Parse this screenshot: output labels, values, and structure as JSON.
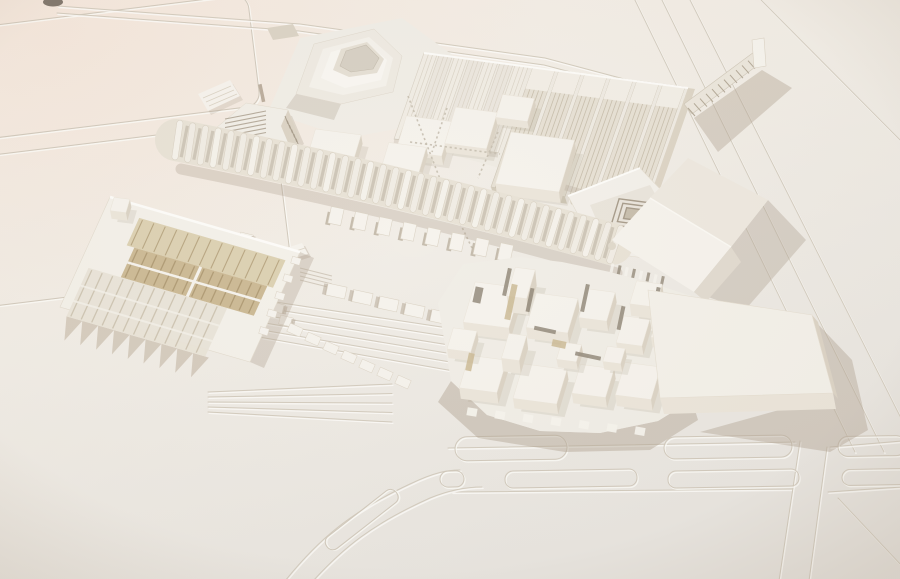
{
  "scene": {
    "type": "photograph",
    "subject": "architectural scale model",
    "description": "Overhead oblique photograph of an all-white architectural site model of a large campus: a stepped ziggurat pavilion, a long ribbed vaulted gallery, rows of striped factory halls, flat exhibition boxes, a tan-glazed greenhouse block, terraced courtyards, a dense cluster of small cubic buildings, a large flat slab hall, a gabled hall, a thin ramp bridge, and engraved roads with traffic islands on the baseboard.",
    "elements": [
      {
        "name": "site-board",
        "label": "baseboard with engraved plots and roads"
      },
      {
        "name": "ziggurat-pavilion",
        "label": "stepped pyramid pavilion with recessed top"
      },
      {
        "name": "factory-halls",
        "label": "row of parallel striped halls"
      },
      {
        "name": "exhibition-boxes",
        "label": "grid of flat-roofed halls"
      },
      {
        "name": "louvre-building",
        "label": "small louvered-roof building"
      },
      {
        "name": "caterpillar-building",
        "label": "long ribbed barrel-vault gallery"
      },
      {
        "name": "greenhouse-building",
        "label": "glazed block with tan striped panels and sawtooth front"
      },
      {
        "name": "terraced-courtyard",
        "label": "stepped terraces and toothed wing walls"
      },
      {
        "name": "spiral-courtyard-building",
        "label": "courtyard building with concentric square steps"
      },
      {
        "name": "gable-hall",
        "label": "large pitched-roof hall"
      },
      {
        "name": "block-cluster",
        "label": "dense cluster of cubic volumes with slots"
      },
      {
        "name": "flat-slab-building",
        "label": "large low flat slab hall"
      },
      {
        "name": "ramp-bridge",
        "label": "thin trussed ramp with end fin"
      },
      {
        "name": "road-islands",
        "label": "engraved roads with rounded traffic islands"
      }
    ]
  },
  "palette": {
    "board_top": "#f7efe7",
    "board_mid": "#f2eee7",
    "board_bottom": "#e9e6e1",
    "pink_cast": "#f4ddcd",
    "vignette": "#a5947f",
    "model_white": "#f6f3ed",
    "model_base": "#f1eee7",
    "model_face_light": "#ece6db",
    "model_face_dark": "#dcd4c6",
    "shadow_warm": "#b1a392",
    "shadow_deep": "#9a8d7b",
    "engraved_line": "#d2cabd",
    "highlight_line": "#fdfcf9",
    "tan_panel": "#cdbb97",
    "tan_panel_dark": "#ab9670",
    "tan_panel_light": "#ddd2b4",
    "translucent_glazing": "#e9e4d8",
    "glazing_stripe": "#cfc6b4",
    "dark_slot": "#8e8475",
    "speck_dark": "#6b6258"
  }
}
